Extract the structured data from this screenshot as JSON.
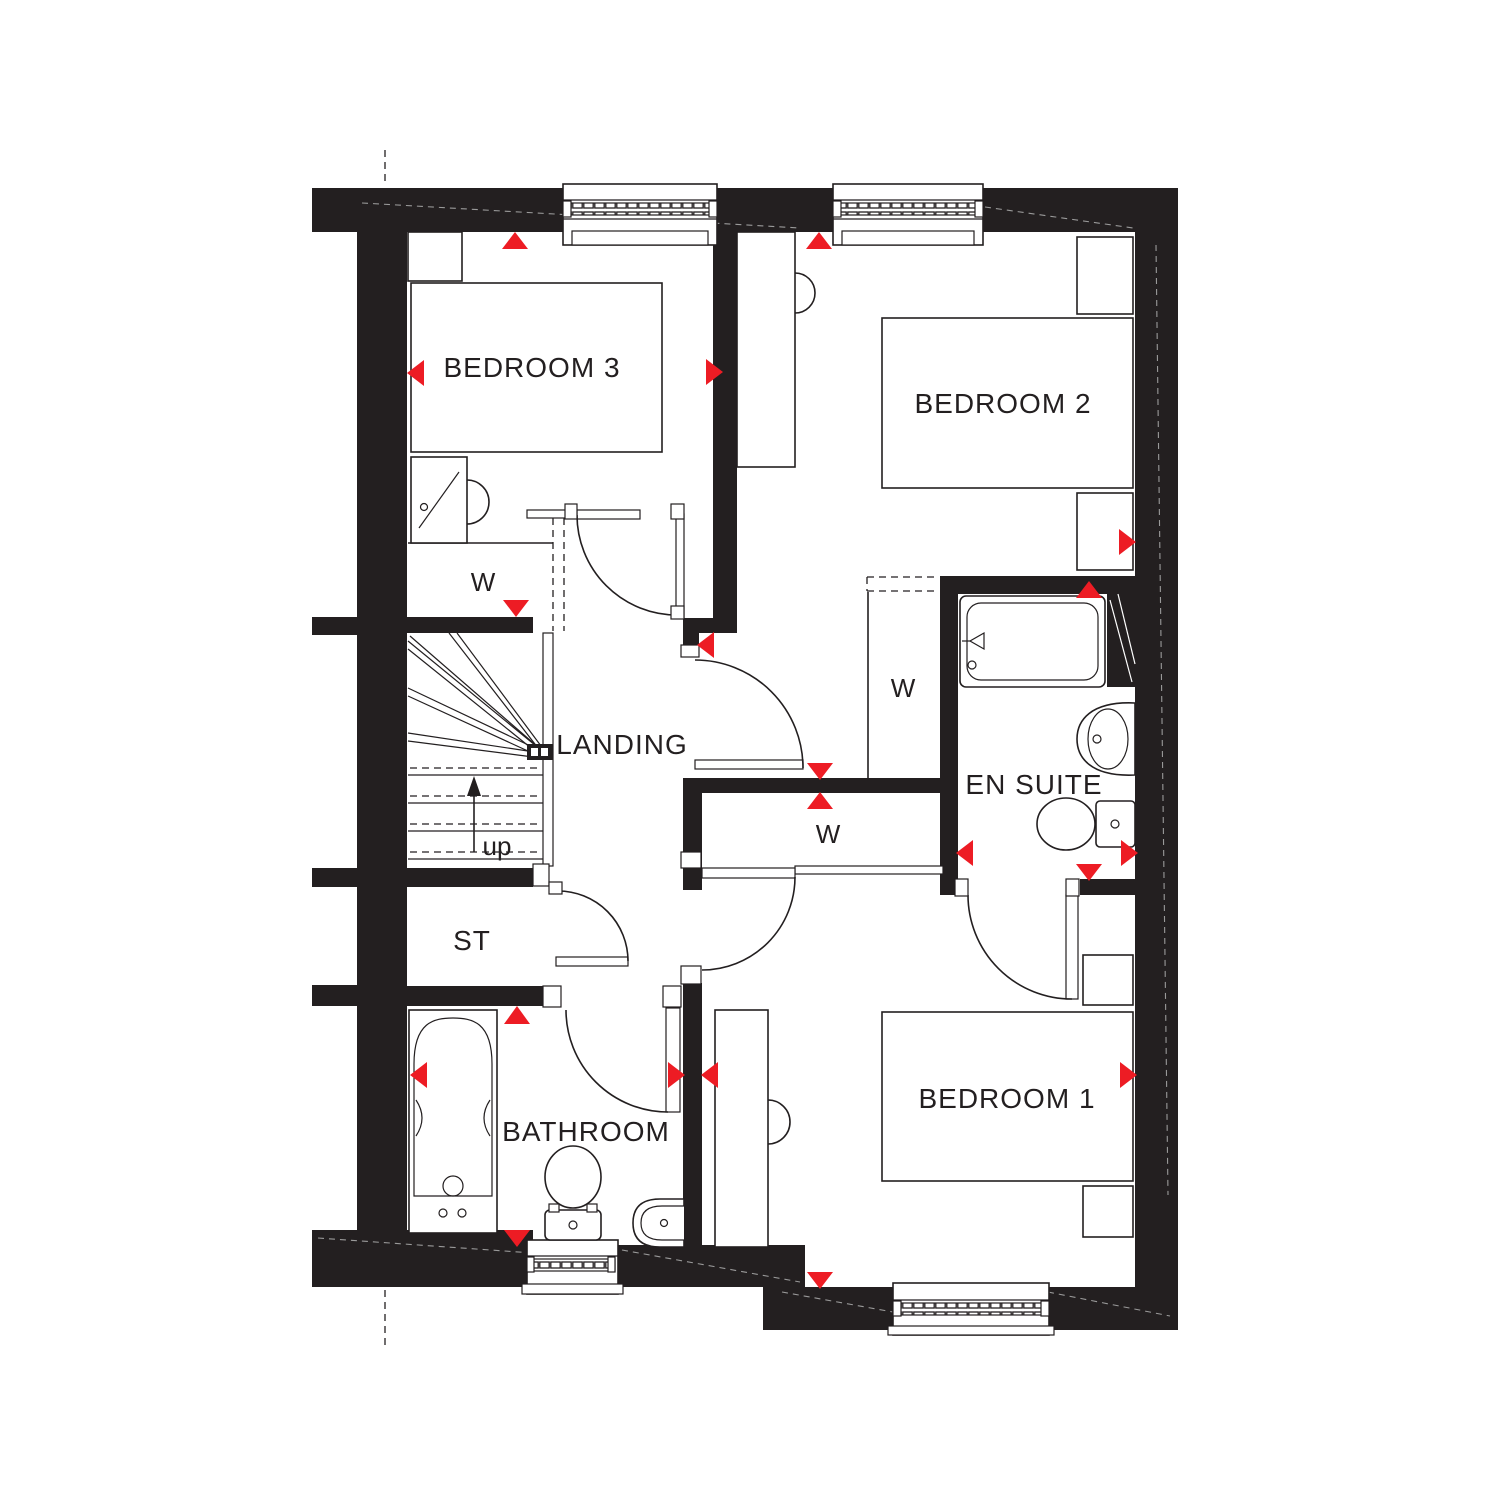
{
  "plan": {
    "type": "floor-plan",
    "rooms": [
      {
        "id": "bedroom-3",
        "label": "BEDROOM 3"
      },
      {
        "id": "bedroom-2",
        "label": "BEDROOM 2"
      },
      {
        "id": "landing",
        "label": "LANDING"
      },
      {
        "id": "en-suite",
        "label": "EN SUITE"
      },
      {
        "id": "storage",
        "label": "ST"
      },
      {
        "id": "bathroom",
        "label": "BATHROOM"
      },
      {
        "id": "bedroom-1",
        "label": "BEDROOM 1"
      }
    ],
    "stairs": {
      "direction_label": "up"
    },
    "wardrobe_label": "W",
    "colors": {
      "wall": "#231f20",
      "marker": "#ed1c24",
      "background": "#ffffff"
    }
  }
}
